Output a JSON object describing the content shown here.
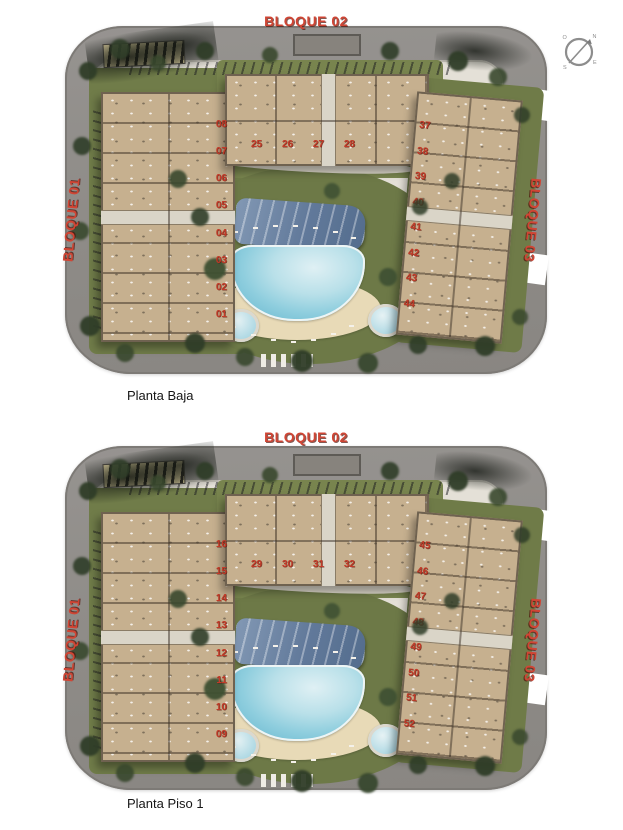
{
  "compass": {
    "n": "N",
    "o": "O",
    "e": "E",
    "s": "S"
  },
  "colors": {
    "accent_red": "#c5392b",
    "road_gray": "#8f8c88",
    "lawn_green": "#73804b",
    "building_tan": "#c6b08f",
    "pool_blue": "#8fcede",
    "sand": "#e8dab7",
    "pergola_blue": "#61799a"
  },
  "plans": [
    {
      "caption": "Planta Baja",
      "labels": {
        "top": "BLOQUE 02",
        "left": "BLOQUE 01",
        "right": "BLOQUE 03"
      },
      "units": {
        "bloque01": [
          "08",
          "07",
          "06",
          "05",
          "04",
          "03",
          "02",
          "01"
        ],
        "bloque02": [
          "25",
          "26",
          "27",
          "28"
        ],
        "bloque03": [
          "37",
          "38",
          "39",
          "40",
          "41",
          "42",
          "43",
          "44"
        ]
      }
    },
    {
      "caption": "Planta Piso 1",
      "labels": {
        "top": "BLOQUE 02",
        "left": "BLOQUE 01",
        "right": "BLOQUE 03"
      },
      "units": {
        "bloque01": [
          "16",
          "15",
          "14",
          "13",
          "12",
          "11",
          "10",
          "09"
        ],
        "bloque02": [
          "29",
          "30",
          "31",
          "32"
        ],
        "bloque03": [
          "45",
          "46",
          "47",
          "48",
          "49",
          "50",
          "51",
          "52"
        ]
      }
    }
  ]
}
